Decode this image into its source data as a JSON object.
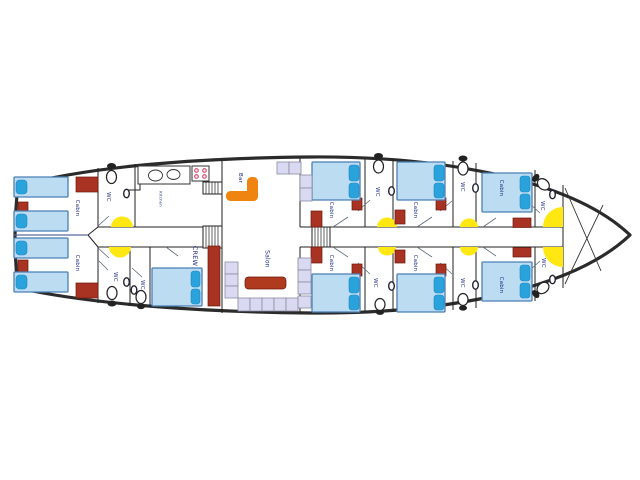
{
  "plan": {
    "title": "yacht-lower-deck-plan",
    "labels": {
      "cabin": "Cabin",
      "wc": "WC",
      "crew": "CREW",
      "bar": "Bar",
      "salon": "Salon",
      "kitchen": "Kitchen"
    },
    "rooms": [
      {
        "name": "stern-cabin-top",
        "label": "Cabin",
        "beds": 2
      },
      {
        "name": "stern-cabin-bottom",
        "label": "Cabin",
        "beds": 2
      },
      {
        "name": "stern-wc-top",
        "label": "WC"
      },
      {
        "name": "aft-wc-1",
        "label": "WC"
      },
      {
        "name": "aft-wc-2",
        "label": "WC"
      },
      {
        "name": "galley",
        "label": "Kitchen"
      },
      {
        "name": "crew-cabin",
        "label": "CREW",
        "beds": 1
      },
      {
        "name": "bar-area",
        "label": "Bar"
      },
      {
        "name": "salon",
        "label": "Salon"
      },
      {
        "name": "mid-cabin-1-top",
        "label": "Cabin",
        "beds": 1
      },
      {
        "name": "mid-cabin-1-bottom",
        "label": "Cabin",
        "beds": 1
      },
      {
        "name": "mid-wc-1-top",
        "label": "WC"
      },
      {
        "name": "mid-wc-1-bottom",
        "label": "WC"
      },
      {
        "name": "mid-cabin-2-top",
        "label": "Cabin",
        "beds": 1
      },
      {
        "name": "mid-cabin-2-bottom",
        "label": "Cabin",
        "beds": 1
      },
      {
        "name": "mid-wc-2-top",
        "label": "WC"
      },
      {
        "name": "mid-wc-2-bottom",
        "label": "WC"
      },
      {
        "name": "bow-cabin-top",
        "label": "Cabin",
        "beds": 1
      },
      {
        "name": "bow-cabin-bottom",
        "label": "Cabin",
        "beds": 1
      },
      {
        "name": "bow-wc-top",
        "label": "WC"
      },
      {
        "name": "bow-wc-bottom",
        "label": "WC"
      }
    ],
    "furniture_counts": {
      "single_beds": 4,
      "double_beds": 7,
      "toilets": 9,
      "wall_sinks": 9,
      "galley_sinks": 2,
      "stove_burners": 4,
      "stair_flights": 3,
      "yellow_tables": 8,
      "seat_cushions": 13
    },
    "colors": {
      "hull_outline": "#2b2b2b",
      "bed_fill": "#bcdcf2",
      "bed_border": "#4a7fb5",
      "pillow_blue": "#2aa3dc",
      "furniture_red": "#a93322",
      "salon_table_red": "#b03a1e",
      "bar_counter_orange": "#ef8410",
      "table_yellow": "#ffe712",
      "seat_lavender": "#d9daf2",
      "label_navy": "#1b2c85"
    }
  }
}
